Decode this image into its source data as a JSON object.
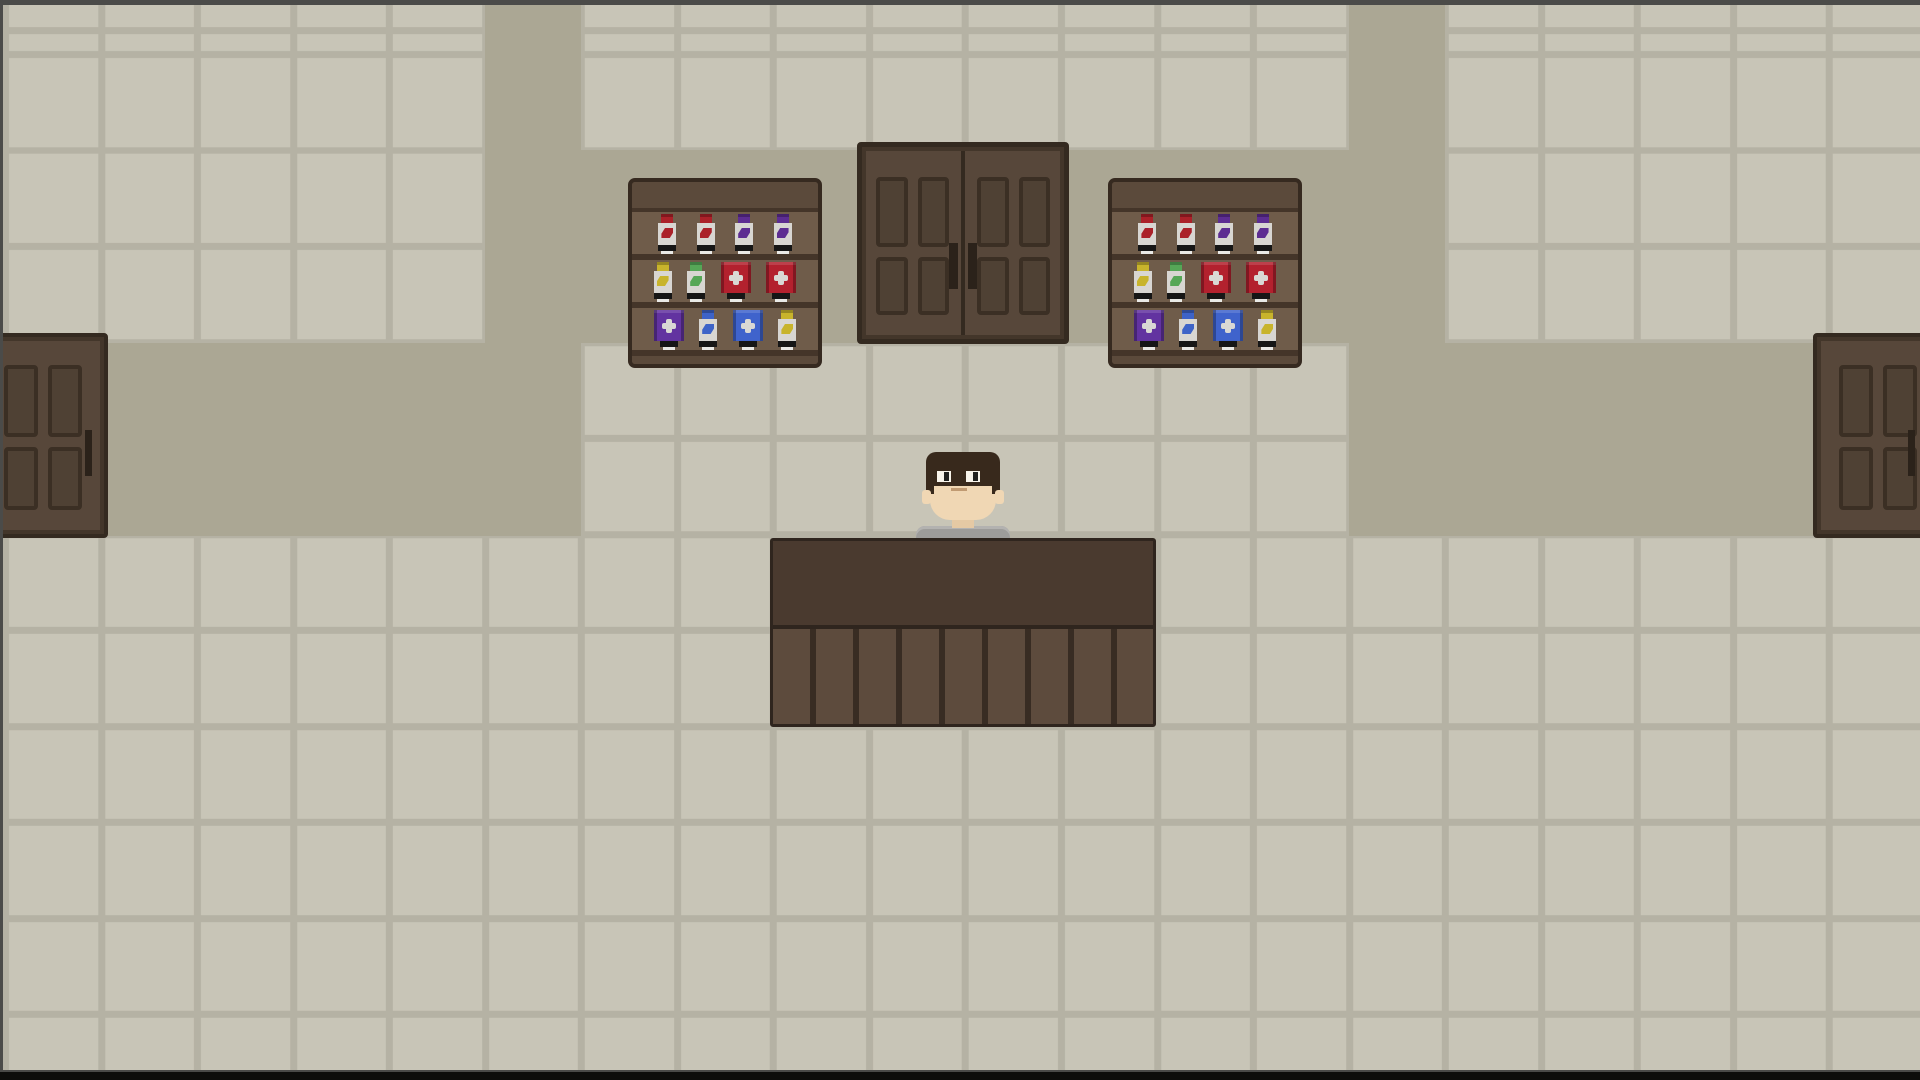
{
  "scene": {
    "name": "pixel-shop-interior",
    "viewport": {
      "width": 1920,
      "height": 1080
    },
    "floor": {
      "tile_size": 96,
      "grout_width": 7
    }
  },
  "palette": {
    "tile": "#c8c5b7",
    "grout": "#b5b2a4",
    "walkway": "#aba794",
    "door-face": "#57473a",
    "door-border": "#342a20",
    "door-inner": "#43362a",
    "panel-fill": "#4f4134",
    "panel-border": "#3b2f24",
    "handle": "#2b221a",
    "shelf-frame": "#5b4a3b",
    "shelf-border": "#362a20",
    "shelf-row-bg": "#6f5c4a",
    "shelf-board": "#443529",
    "counter-top": "#4a3a2f",
    "counter-front": "#5d4b3d",
    "counter-line": "#382c23",
    "counter-border": "#2f251e",
    "bottle-body": "#d8d6d2",
    "band": "#161616",
    "tag": "#e9e9e6",
    "emblem": "#d9d8d4",
    "red": "#ab2129",
    "purple": "#5d2d92",
    "yellow": "#c8b42c",
    "green": "#56a757",
    "blue": "#3d63c8",
    "box-red": "#b3212e",
    "box-purple": "#6233a0",
    "box-blue": "#3f63cc",
    "skin": "#f0d7b4",
    "skin-shade": "#e5c9a4",
    "hair": "#38291c",
    "shirt": "#9d9c9a",
    "shirt-light": "#b3b2b0",
    "eye-white": "#f7f3ea",
    "pupil": "#20201e",
    "mouth": "#c09a72",
    "edge-dark": "#4b4b49",
    "edge-black": "#0d0d0b"
  },
  "walkways": [
    {
      "name": "walkway-vertical-left",
      "x": 485,
      "y": 0,
      "w": 96,
      "h": 536
    },
    {
      "name": "walkway-vertical-right",
      "x": 1349,
      "y": 0,
      "w": 96,
      "h": 536
    },
    {
      "name": "walkway-upper-middle",
      "x": 581,
      "y": 150,
      "w": 768,
      "h": 193
    },
    {
      "name": "walkway-band-left",
      "x": 0,
      "y": 343,
      "w": 485,
      "h": 193
    },
    {
      "name": "walkway-band-right",
      "x": 1445,
      "y": 343,
      "w": 475,
      "h": 193
    }
  ],
  "shelves": {
    "size": {
      "w": 194,
      "h": 190
    },
    "positions": [
      {
        "id": "shelf-left",
        "x": 628,
        "y": 178
      },
      {
        "id": "shelf-right",
        "x": 1108,
        "y": 178
      }
    ],
    "rows": [
      [
        "potion-red",
        "potion-red",
        "potion-purple",
        "potion-purple"
      ],
      [
        "potion-yellow",
        "potion-green",
        "medicine-red",
        "medicine-red"
      ],
      [
        "medicine-purple",
        "potion-blue",
        "medicine-blue",
        "potion-yellow"
      ]
    ]
  },
  "doors": {
    "double_door": {
      "x": 857,
      "y": 142,
      "w": 212,
      "h": 202,
      "leaves": 2,
      "panels_per_leaf": 4
    },
    "left_door": {
      "x": -22,
      "y": 333,
      "w": 130,
      "h": 205,
      "panels": 4
    },
    "right_door": {
      "x": 1813,
      "y": 333,
      "w": 130,
      "h": 205,
      "panels": 4
    }
  },
  "counter": {
    "x": 770,
    "y": 538,
    "w": 386,
    "h": 189,
    "planks": 9
  },
  "npc": {
    "role": "shopkeeper",
    "x": 916,
    "y": 452
  }
}
